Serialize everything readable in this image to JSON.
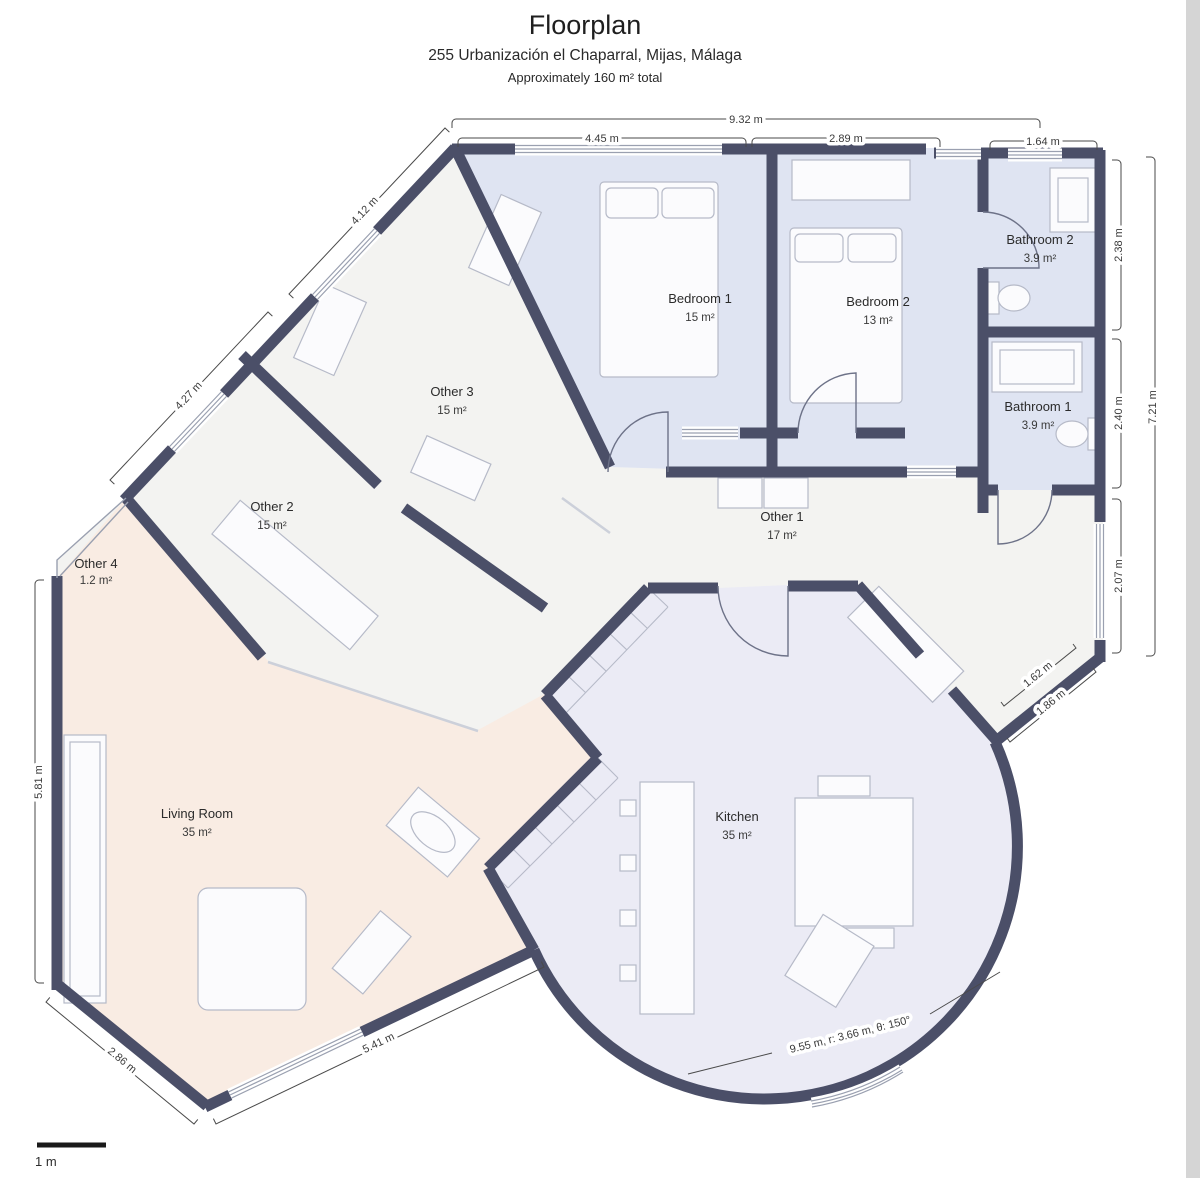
{
  "header": {
    "title": "Floorplan",
    "subtitle": "255 Urbanización el Chaparral, Mijas, Málaga",
    "total_note": "Approximately 160 m² total"
  },
  "rooms": [
    {
      "name": "Bedroom 1",
      "area": "15 m²"
    },
    {
      "name": "Bedroom 2",
      "area": "13 m²"
    },
    {
      "name": "Bathroom 2",
      "area": "3.9 m²"
    },
    {
      "name": "Bathroom 1",
      "area": "3.9 m²"
    },
    {
      "name": "Other 3",
      "area": "15 m²"
    },
    {
      "name": "Other 2",
      "area": "15 m²"
    },
    {
      "name": "Other 4",
      "area": "1.2 m²"
    },
    {
      "name": "Other 1",
      "area": "17 m²"
    },
    {
      "name": "Living Room",
      "area": "35 m²"
    },
    {
      "name": "Kitchen",
      "area": "35 m²"
    }
  ],
  "dims": {
    "top_total": "9.32 m",
    "top_left": "4.45 m",
    "top_mid": "2.89 m",
    "top_right": "1.64 m",
    "right_total": "7.21 m",
    "right_a": "2.38 m",
    "right_b": "2.40 m",
    "right_c": "2.07 m",
    "left_side": "5.81 m",
    "diag_upper": "4.12 m",
    "diag_lower": "4.27 m",
    "bottom_left": "2.86 m",
    "bottom_edge": "5.41 m",
    "kitchen_a": "1.62 m",
    "kitchen_b": "1.86 m",
    "arc_note": "9.55 m, r: 3.66 m, θ: 150°",
    "scale_label": "1 m"
  },
  "colors": {
    "wall": "#4b4f68",
    "room_blue": "#dfe4f2",
    "room_pink": "#f9ece3",
    "room_lav": "#ebebf5",
    "room_neutral": "#f3f3f1"
  }
}
